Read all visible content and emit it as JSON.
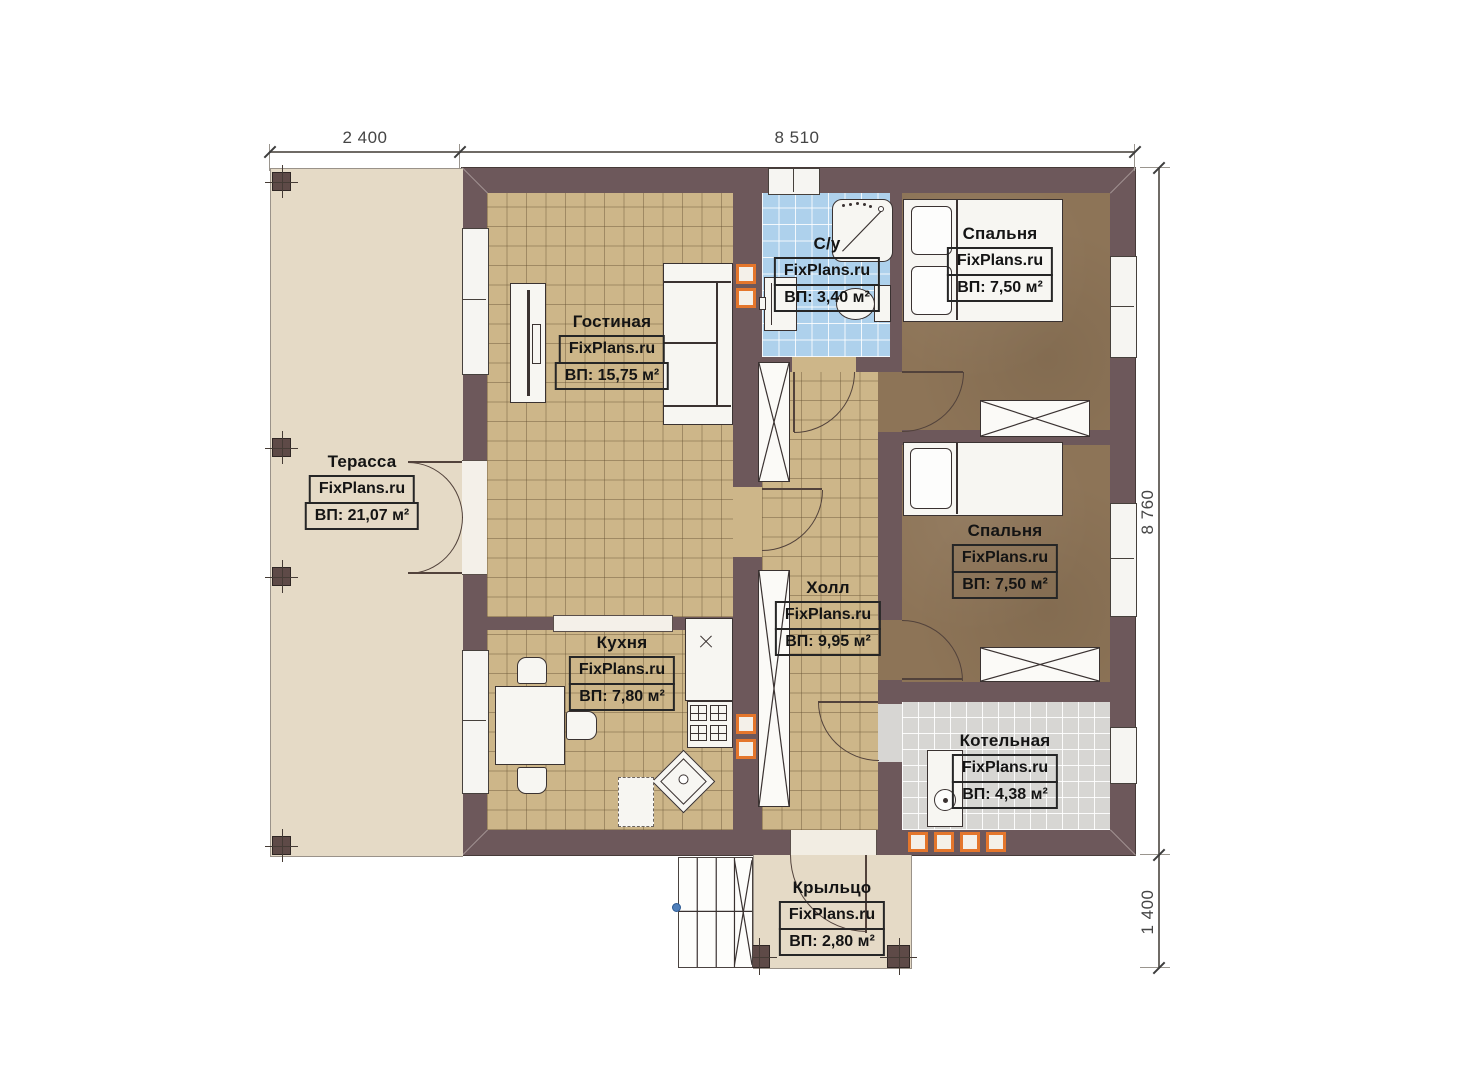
{
  "watermark": "FixPlans.ru",
  "dimensions": {
    "terrace_width": "2 400",
    "house_width": "8 510",
    "house_depth": "8 760",
    "porch_depth": "1 400"
  },
  "rooms": {
    "terrace": {
      "name": "Терасса",
      "area": "ВП: 21,07 м²"
    },
    "living": {
      "name": "Гостиная",
      "area": "ВП: 15,75 м²"
    },
    "bathroom": {
      "name": "С/у",
      "area": "ВП: 3,40 м²"
    },
    "bedroom1": {
      "name": "Спальня",
      "area": "ВП: 7,50 м²"
    },
    "bedroom2": {
      "name": "Спальня",
      "area": "ВП: 7,50 м²"
    },
    "hall": {
      "name": "Холл",
      "area": "ВП: 9,95 м²"
    },
    "kitchen": {
      "name": "Кухня",
      "area": "ВП: 7,80 м²"
    },
    "boiler": {
      "name": "Котельная",
      "area": "ВП: 4,38 м²"
    },
    "porch": {
      "name": "Крыльцо",
      "area": "ВП: 2,80 м²"
    }
  },
  "colors": {
    "wall": "#6d585b",
    "floor-tan": "#cdb689",
    "floor-blue": "#aed1ec",
    "floor-gray": "#d7d6d3",
    "floor-brown": "#8d7457",
    "floor-beige": "#e5dac6",
    "vent-orange": "#e4762c",
    "line": "#3a3231"
  }
}
